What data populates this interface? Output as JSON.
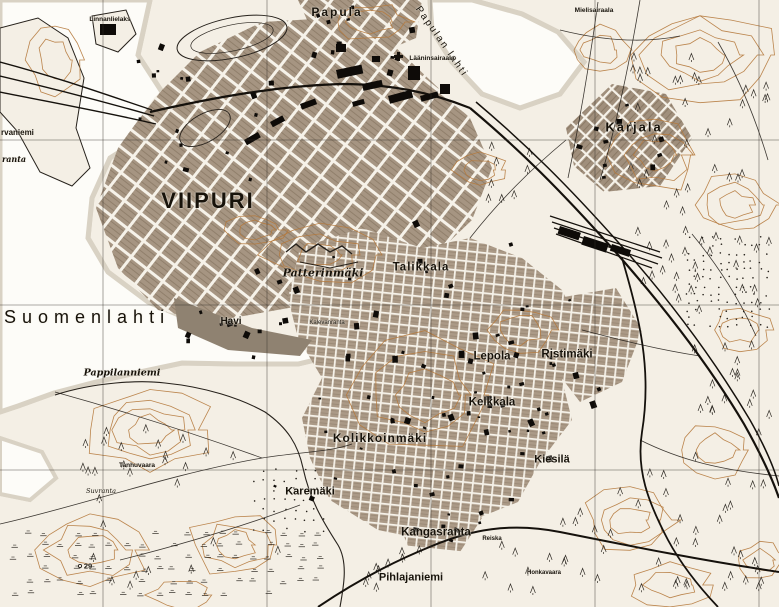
{
  "map": {
    "kind": "historical topographic map",
    "main_title": "VIIPURI",
    "colors": {
      "paper": "#f4efe5",
      "water": "#fdfcf8",
      "contour": "#b5793c",
      "urban_block": "#a69582",
      "ink": "#1c1813",
      "grid_line": "#35302a"
    },
    "grid": {
      "vertical_x": [
        103,
        267,
        431,
        595,
        759
      ],
      "horizontal_y": [
        140,
        305,
        470
      ]
    },
    "labels": [
      {
        "id": "viipuri",
        "text": "VIIPURI",
        "x": 208,
        "y": 201,
        "size": 22,
        "spacing": 2,
        "weight": 600
      },
      {
        "id": "suomenlahti",
        "text": "Suomenlahti",
        "x": 4,
        "y": 317,
        "size": 18,
        "spacing": 6,
        "weight": 400,
        "align": "left"
      },
      {
        "id": "papula",
        "text": "Papula",
        "x": 337,
        "y": 12,
        "size": 12,
        "spacing": 2,
        "weight": 600
      },
      {
        "id": "papulan-lahti",
        "text": "Papulan lahti",
        "x": 441,
        "y": 42,
        "size": 10,
        "spacing": 2,
        "weight": 400,
        "rotate": 55
      },
      {
        "id": "karjala",
        "text": "Karjala",
        "x": 634,
        "y": 127,
        "size": 13,
        "spacing": 2,
        "weight": 600
      },
      {
        "id": "patterinmaki",
        "text": "Patterinmäki",
        "x": 323,
        "y": 273,
        "size": 11,
        "weight": 600,
        "italic": true,
        "serif": true
      },
      {
        "id": "talikkala",
        "text": "Talikkala",
        "x": 421,
        "y": 268,
        "size": 11.5,
        "spacing": 1,
        "weight": 600
      },
      {
        "id": "havi",
        "text": "Havi",
        "x": 231,
        "y": 322,
        "size": 10,
        "weight": 600
      },
      {
        "id": "pappilanniemi",
        "text": "Pappilanniemi",
        "x": 122,
        "y": 373,
        "size": 9.5,
        "weight": 600,
        "italic": true,
        "serif": true
      },
      {
        "id": "lepola",
        "text": "Lepola",
        "x": 492,
        "y": 357,
        "size": 11.5,
        "weight": 600
      },
      {
        "id": "ristimaki",
        "text": "Ristimäki",
        "x": 567,
        "y": 355,
        "size": 11.5,
        "weight": 600
      },
      {
        "id": "kelkkala",
        "text": "Kelkkala",
        "x": 492,
        "y": 403,
        "size": 11.5,
        "weight": 600
      },
      {
        "id": "kolikkoinmaki",
        "text": "Kolikkoinmäki",
        "x": 380,
        "y": 438,
        "size": 12,
        "spacing": 1,
        "weight": 600
      },
      {
        "id": "kiesila",
        "text": "Kiesilä",
        "x": 552,
        "y": 460,
        "size": 11,
        "weight": 600
      },
      {
        "id": "karemaki",
        "text": "Karemäki",
        "x": 310,
        "y": 492,
        "size": 11,
        "weight": 600
      },
      {
        "id": "kangasranta",
        "text": "Kangasranta",
        "x": 436,
        "y": 533,
        "size": 11.5,
        "weight": 600
      },
      {
        "id": "pihlajaniemi",
        "text": "Pihlajaniemi",
        "x": 411,
        "y": 578,
        "size": 11,
        "weight": 600
      },
      {
        "id": "tervaniemi-cut",
        "text": "rvaniemi",
        "x": 1,
        "y": 133,
        "size": 8,
        "weight": 600,
        "align": "left"
      },
      {
        "id": "ranta-cut",
        "text": "ranta",
        "x": 2,
        "y": 159,
        "size": 8,
        "weight": 600,
        "align": "left",
        "italic": true,
        "serif": true
      },
      {
        "id": "mielisairaala",
        "text": "Mielisairaala",
        "x": 594,
        "y": 11,
        "size": 6.5,
        "weight": 600
      },
      {
        "id": "laaninsairaala",
        "text": "Lääninsairaala",
        "x": 432,
        "y": 59,
        "size": 6.5,
        "weight": 600
      },
      {
        "id": "linnan-label",
        "text": "Linnanlielaks",
        "x": 110,
        "y": 20,
        "size": 6.5,
        "weight": 600
      },
      {
        "id": "tanhuvaara",
        "text": "Tanhuvaara",
        "x": 137,
        "y": 466,
        "size": 6.5,
        "weight": 600
      },
      {
        "id": "suvranta",
        "text": "Suvranta",
        "x": 101,
        "y": 491,
        "size": 6.5,
        "weight": 400,
        "italic": true,
        "serif": true
      },
      {
        "id": "spot-height-29",
        "text": "29",
        "x": 88,
        "y": 566,
        "size": 7.5,
        "weight": 600
      },
      {
        "id": "reiska",
        "text": "Reiska",
        "x": 492,
        "y": 539,
        "size": 6,
        "weight": 600
      },
      {
        "id": "honkavaara",
        "text": "Honkavaara",
        "x": 544,
        "y": 573,
        "size": 6,
        "weight": 600
      },
      {
        "id": "kalevanranta",
        "text": "Kalevanranta",
        "x": 327,
        "y": 323,
        "size": 6,
        "weight": 400
      }
    ],
    "icons": [
      {
        "id": "hospital-cross",
        "x": 398,
        "y": 58
      }
    ]
  }
}
